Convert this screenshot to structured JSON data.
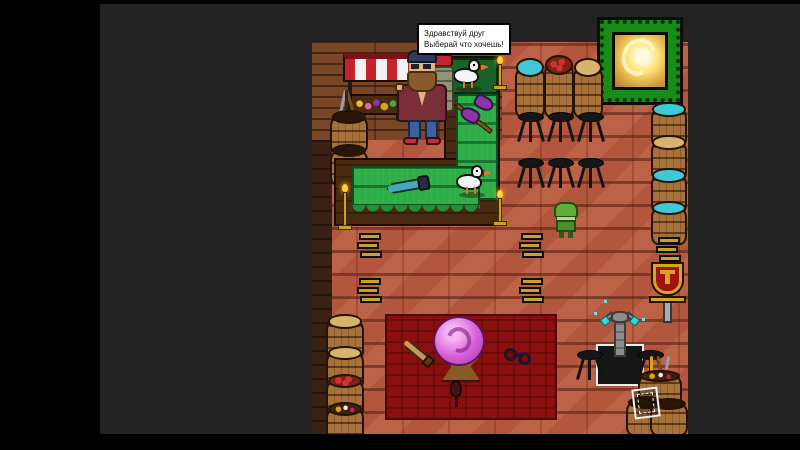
{
  "scene": {
    "type": "top-down pixel-art RPG shop interior",
    "dialogue": {
      "speaker": "merchant",
      "line1": "Здравствуй друг",
      "line2": "Выберай что хочешь!"
    }
  },
  "entities": {
    "merchant_npc": "bearded shopkeeper with large backpack and red bedroll",
    "customer_npc": "small green hooded character",
    "portal": "glowing yellow portal in jagged green frame",
    "market_stall": "red-white striped awning with produce shelf",
    "counter": "L-shaped wooden counter with green tabletop",
    "seagull": "white gull perched on counter",
    "battle_axe": "purple double-bladed axe on green table",
    "dagger": "teal dagger on green table",
    "crystal_ball": "pink crystal ball on wooden stand",
    "carpet": "dark red ritual carpet",
    "knife": "curved knife on carpet",
    "shackles": "iron shackles on carpet",
    "rat": "small rat on carpet",
    "statue": "stone idol holding glowing cyan gems on white-rimmed pedestal",
    "banner_standard": "red shield standard with gold tau emblem",
    "gold_ingots": "stacks of gold bars on floor",
    "barrels": "storage barrels: water, apples, grain, bottled goods, tools",
    "stools": "black three-legged bar stools",
    "candles": "gold candlesticks with lit flames",
    "picture_frame": "white framed sign leaning on barrels"
  },
  "colors": {
    "background": "#232323",
    "frame_black": "#000000",
    "floor": "#b2573e",
    "wall": "#7a4628",
    "counter": "#4a2a10",
    "table_green": "#2fae47",
    "carpet_red": "#8a1010",
    "portal_green": "#188c18",
    "portal_glow": "#ffe37a",
    "awning_red": "#c8222a",
    "gold": "#c9a227",
    "cyan": "#41c8d8",
    "orb_pink": "#d95fd9"
  }
}
